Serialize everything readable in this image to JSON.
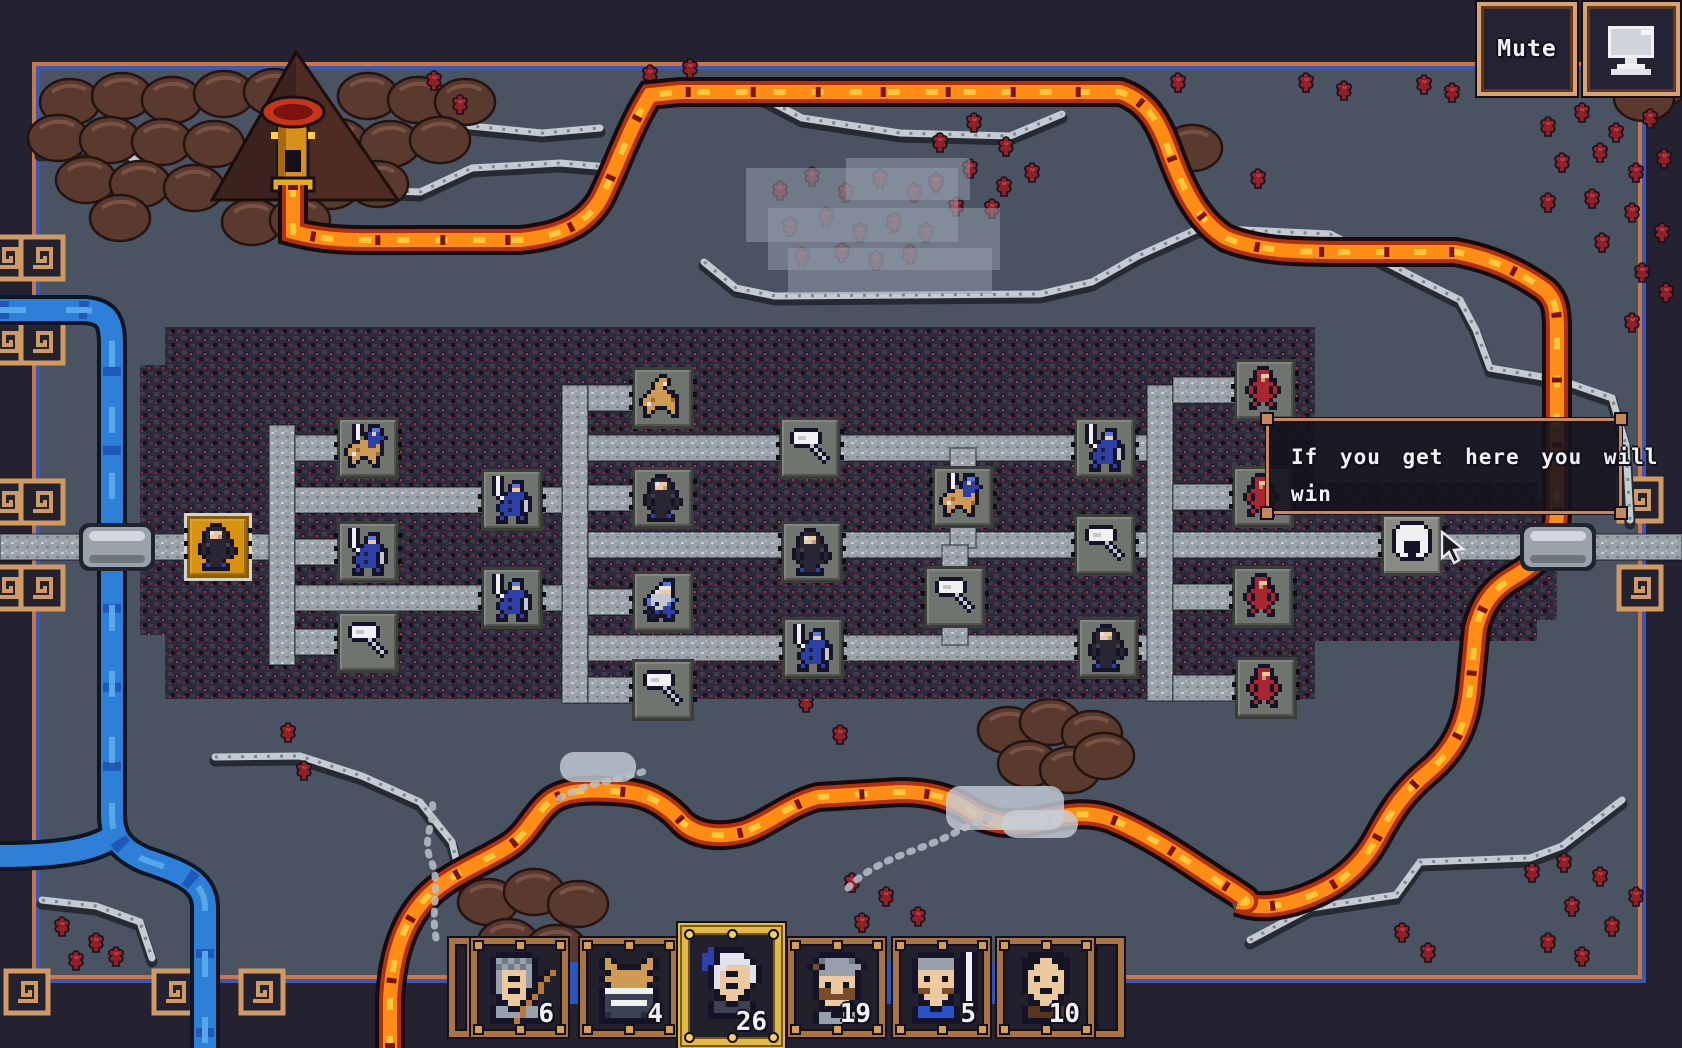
{
  "ui": {
    "mute_label": "Mute"
  },
  "tooltip": {
    "text": "If you get here you will win",
    "lines": [
      "If you get here you will",
      "win"
    ],
    "x": 1266,
    "y": 418,
    "w": 356,
    "h": 96
  },
  "party": {
    "slots": [
      {
        "icon": "archer-portrait",
        "count": "6",
        "x": 471,
        "selected": false
      },
      {
        "icon": "horned-helm-portrait",
        "count": "4",
        "x": 580,
        "selected": false
      },
      {
        "icon": "elder-portrait",
        "count": "26",
        "x": 682,
        "selected": true
      },
      {
        "icon": "mustache-portrait",
        "count": "19",
        "x": 788,
        "selected": false
      },
      {
        "icon": "capped-sword-portrait",
        "count": "5",
        "x": 893,
        "selected": false
      },
      {
        "icon": "bald-portrait",
        "count": "10",
        "x": 997,
        "selected": false
      }
    ]
  },
  "map": {
    "nodes": [
      {
        "icon": "monk-icon",
        "type": "start",
        "x": 218,
        "y": 547
      },
      {
        "icon": "cavalry-icon",
        "x": 368,
        "y": 448
      },
      {
        "icon": "knight-icon",
        "x": 368,
        "y": 552
      },
      {
        "icon": "hammer-icon",
        "x": 368,
        "y": 642
      },
      {
        "icon": "knight-icon",
        "x": 512,
        "y": 500
      },
      {
        "icon": "knight-icon",
        "x": 512,
        "y": 598
      },
      {
        "icon": "horse-icon",
        "x": 663,
        "y": 398
      },
      {
        "icon": "monk-icon",
        "x": 663,
        "y": 498
      },
      {
        "icon": "swordsman-icon",
        "x": 663,
        "y": 602
      },
      {
        "icon": "hammer-icon",
        "x": 663,
        "y": 690
      },
      {
        "icon": "hammer-icon",
        "x": 810,
        "y": 448
      },
      {
        "icon": "monk-icon",
        "x": 812,
        "y": 552
      },
      {
        "icon": "knight-icon",
        "x": 813,
        "y": 648
      },
      {
        "icon": "cavalry-icon",
        "x": 963,
        "y": 497
      },
      {
        "icon": "hammer-icon",
        "x": 955,
        "y": 597
      },
      {
        "icon": "knight-icon",
        "x": 1105,
        "y": 448
      },
      {
        "icon": "hammer-icon",
        "x": 1105,
        "y": 545
      },
      {
        "icon": "monk-icon",
        "x": 1108,
        "y": 648
      },
      {
        "icon": "red-guard-icon",
        "faction": "enemy",
        "x": 1265,
        "y": 390
      },
      {
        "icon": "red-guard-icon",
        "faction": "enemy",
        "x": 1263,
        "y": 497
      },
      {
        "icon": "red-guard-icon",
        "faction": "enemy",
        "x": 1263,
        "y": 597
      },
      {
        "icon": "red-guard-icon",
        "faction": "enemy",
        "x": 1266,
        "y": 688
      },
      {
        "icon": "helm-icon",
        "type": "end",
        "x": 1412,
        "y": 545
      }
    ],
    "paths": [
      [
        0,
        534,
        192,
        26
      ],
      [
        249,
        534,
        46,
        26
      ],
      [
        269,
        425,
        26,
        240
      ],
      [
        295,
        435,
        44,
        26
      ],
      [
        295,
        539,
        44,
        26
      ],
      [
        295,
        629,
        44,
        26
      ],
      [
        295,
        487,
        192,
        26
      ],
      [
        295,
        585,
        192,
        26
      ],
      [
        562,
        385,
        26,
        318
      ],
      [
        541,
        487,
        21,
        26
      ],
      [
        541,
        585,
        21,
        26
      ],
      [
        588,
        385,
        46,
        26
      ],
      [
        588,
        485,
        46,
        26
      ],
      [
        588,
        589,
        46,
        26
      ],
      [
        588,
        677,
        46,
        26
      ],
      [
        588,
        435,
        585,
        26
      ],
      [
        588,
        532,
        800,
        26
      ],
      [
        588,
        635,
        585,
        26
      ],
      [
        950,
        448,
        26,
        100
      ],
      [
        942,
        545,
        26,
        100
      ],
      [
        1147,
        385,
        26,
        316
      ],
      [
        1173,
        377,
        62,
        26
      ],
      [
        1173,
        484,
        62,
        26
      ],
      [
        1173,
        584,
        62,
        26
      ],
      [
        1173,
        675,
        62,
        26
      ],
      [
        1442,
        534,
        240,
        26
      ]
    ],
    "bridges": [
      [
        117,
        547
      ],
      [
        1558,
        547
      ]
    ],
    "terrain": {
      "rock_rects": [
        [
          165,
          327,
          1150,
          372
        ],
        [
          1315,
          483,
          222,
          158
        ],
        [
          140,
          365,
          25,
          270
        ],
        [
          1537,
          500,
          20,
          120
        ]
      ],
      "river_main": "M0,310 L85,310 C108,312 112,322 112,345 L112,815 C112,838 122,850 145,860 C180,872 205,880 205,908 L205,1048",
      "river_branch": "M118,832 C100,850 60,856 0,856",
      "lava_a": "M293,185 L293,232 C330,242 360,240 420,240 L520,240 C560,236 585,225 600,200 C615,172 628,130 650,95 L680,92 L1120,92 C1145,100 1158,120 1168,148 C1180,182 1196,220 1226,238 C1260,252 1300,252 1350,252 L1455,252 C1490,258 1520,272 1545,290 C1556,300 1557,312 1557,330 L1557,515 C1555,545 1540,562 1512,578 C1492,590 1482,605 1476,628 L1470,690 C1466,728 1452,752 1428,772 C1404,792 1392,810 1378,836 C1362,866 1340,884 1310,896 C1285,906 1260,910 1238,902",
      "lava_b": "M390,1048 L390,1000 C392,958 402,922 428,896 C452,872 486,862 512,844 C530,830 536,812 552,800 C570,788 600,790 625,792 C650,794 668,806 682,822 C696,836 720,838 744,832 C768,824 790,804 818,797 L900,792 C930,792 952,798 972,812 C990,824 1015,826 1042,820 C1068,814 1092,810 1118,822 C1150,836 1180,856 1210,876 C1234,892 1262,906 1238,902",
      "ridges": [
        "M40,152 L118,148 L162,180 L232,186 L305,188 L420,192 L472,168 L560,163 L620,168",
        "M428,108 L470,126 L542,133 L600,128",
        "M704,262 L736,288 L775,296 L1040,294 L1092,282 L1138,256 L1200,228 L1330,234 L1424,282 L1460,300 L1476,330 L1490,368",
        "M1490,368 L1560,380 L1612,398 L1626,445 L1630,520",
        "M760,96 L802,118 L900,133 L1010,136 L1062,114",
        "M42,900 L96,906 L140,922 L152,958",
        "M215,757 L300,756 L362,776 L420,802 L452,842 L462,884",
        "M1250,940 L1310,908 L1396,895 L1420,862 L1530,858 L1562,846 L1622,800"
      ],
      "mounds": [
        [
          70,
          102
        ],
        [
          122,
          96
        ],
        [
          172,
          100
        ],
        [
          224,
          94
        ],
        [
          274,
          92
        ],
        [
          368,
          96
        ],
        [
          418,
          100
        ],
        [
          465,
          102
        ],
        [
          58,
          138
        ],
        [
          110,
          140
        ],
        [
          162,
          142
        ],
        [
          214,
          144
        ],
        [
          338,
          142
        ],
        [
          390,
          144
        ],
        [
          440,
          140
        ],
        [
          86,
          180
        ],
        [
          140,
          184
        ],
        [
          194,
          188
        ],
        [
          330,
          186
        ],
        [
          378,
          184
        ],
        [
          120,
          218
        ],
        [
          252,
          222
        ],
        [
          300,
          220
        ],
        [
          488,
          902
        ],
        [
          534,
          892
        ],
        [
          578,
          904
        ],
        [
          508,
          942
        ],
        [
          556,
          948
        ],
        [
          1008,
          730
        ],
        [
          1050,
          722
        ],
        [
          1092,
          734
        ],
        [
          1028,
          764
        ],
        [
          1070,
          770
        ],
        [
          1104,
          756
        ],
        [
          1630,
          66
        ],
        [
          1662,
          82
        ],
        [
          1644,
          98
        ],
        [
          1192,
          148
        ]
      ],
      "volcano": "296,52 398,200 212,200",
      "trees": [
        [
          940,
          152
        ],
        [
          974,
          132
        ],
        [
          1006,
          156
        ],
        [
          936,
          192
        ],
        [
          970,
          178
        ],
        [
          1004,
          196
        ],
        [
          1032,
          182
        ],
        [
          956,
          216
        ],
        [
          992,
          218
        ],
        [
          434,
          90
        ],
        [
          460,
          114
        ],
        [
          650,
          84
        ],
        [
          690,
          78
        ],
        [
          1424,
          94
        ],
        [
          1452,
          102
        ],
        [
          1548,
          136
        ],
        [
          1582,
          122
        ],
        [
          1616,
          142
        ],
        [
          1650,
          128
        ],
        [
          1562,
          172
        ],
        [
          1600,
          162
        ],
        [
          1636,
          182
        ],
        [
          1664,
          168
        ],
        [
          1548,
          212
        ],
        [
          1592,
          208
        ],
        [
          1632,
          222
        ],
        [
          1662,
          242
        ],
        [
          1602,
          252
        ],
        [
          1642,
          282
        ],
        [
          1666,
          302
        ],
        [
          1632,
          332
        ],
        [
          1258,
          188
        ],
        [
          1306,
          92
        ],
        [
          1344,
          100
        ],
        [
          1178,
          92
        ],
        [
          62,
          936
        ],
        [
          96,
          952
        ],
        [
          76,
          970
        ],
        [
          116,
          966
        ],
        [
          288,
          742
        ],
        [
          304,
          780
        ],
        [
          852,
          892
        ],
        [
          886,
          906
        ],
        [
          918,
          926
        ],
        [
          862,
          932
        ],
        [
          806,
          712
        ],
        [
          840,
          744
        ],
        [
          1402,
          942
        ],
        [
          1428,
          962
        ],
        [
          1532,
          882
        ],
        [
          1564,
          872
        ],
        [
          1600,
          886
        ],
        [
          1636,
          906
        ],
        [
          1572,
          916
        ],
        [
          1612,
          936
        ],
        [
          1548,
          952
        ],
        [
          1582,
          966
        ]
      ],
      "faded_trees": [
        [
          780,
          200
        ],
        [
          812,
          186
        ],
        [
          846,
          202
        ],
        [
          880,
          188
        ],
        [
          914,
          202
        ],
        [
          790,
          236
        ],
        [
          826,
          226
        ],
        [
          860,
          242
        ],
        [
          894,
          232
        ],
        [
          926,
          242
        ],
        [
          802,
          266
        ],
        [
          842,
          262
        ],
        [
          876,
          270
        ],
        [
          910,
          264
        ]
      ],
      "fog": [
        [
          746,
          168,
          212,
          74
        ],
        [
          768,
          208,
          232,
          62
        ],
        [
          788,
          248,
          204,
          46
        ],
        [
          846,
          158,
          124,
          42
        ]
      ],
      "clouds": [
        [
          560,
          752,
          76,
          30
        ],
        [
          946,
          786,
          118,
          44
        ],
        [
          1002,
          810,
          76,
          28
        ]
      ],
      "wisps": [
        "M436,938 C430,906 442,884 430,858 C422,838 436,820 432,800",
        "M848,888 C872,862 912,852 940,840 C962,830 976,820 996,816",
        "M560,798 C588,782 620,780 648,770"
      ],
      "motifs": [
        [
          8,
          258
        ],
        [
          42,
          258
        ],
        [
          8,
          342
        ],
        [
          42,
          342
        ],
        [
          8,
          502
        ],
        [
          42,
          502
        ],
        [
          8,
          588
        ],
        [
          42,
          588
        ],
        [
          27,
          992
        ],
        [
          175,
          992
        ],
        [
          262,
          992
        ],
        [
          1640,
          500
        ],
        [
          1640,
          588
        ]
      ],
      "fountain": {
        "x": 293,
        "y": 112
      }
    }
  },
  "colors": {
    "frame_navy": "#242130",
    "ground": "#4a5362",
    "border_orange": "#c87848",
    "border_blue": "#3a58b8",
    "rock": "#2d2a39",
    "rock_red": "#c23048",
    "road": "#9aa1a9",
    "lava": "#ff8c14",
    "river": "#2e7fd8",
    "gold_tile": "#d7930f",
    "wood": "#a9743f",
    "gold_frame": "#e2b84a",
    "tooltip_border": "#c8875a"
  }
}
